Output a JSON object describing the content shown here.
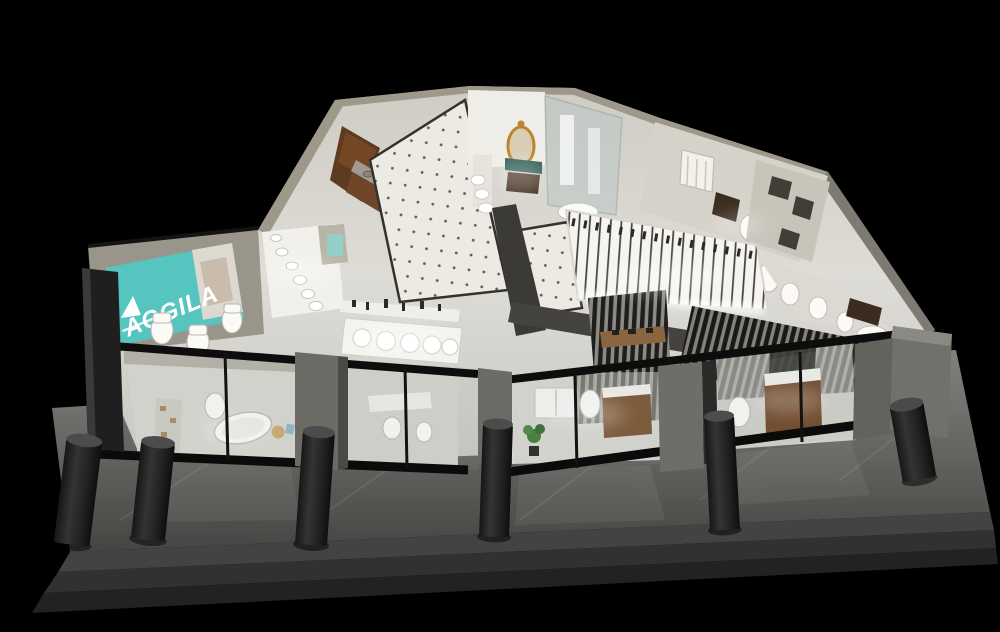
{
  "scene": {
    "description": "Aerial 3D render of a bathroom-fixtures showroom at night on black background",
    "brand_sign": {
      "text": "AGGILA",
      "bg_color": "#57c5bf",
      "text_color": "#ffffff"
    },
    "palette": {
      "background": "#000000",
      "showroom_floor": "#d7d5cf",
      "dotted_tile": "#eceae3",
      "beige_wall": "#9a958a",
      "wood_cabinet": "#6e4526",
      "walkway": "#6e6e6a",
      "steps": "#3a3a3a",
      "bollard": "#242424",
      "pilaster": "#6b6a64",
      "glass_frame": "#0d0d0d",
      "slat_dark": "#1e1e1c",
      "gold_mirror": "#b9862f",
      "plant_green": "#3f7a36",
      "teal_sign": "#57c5bf"
    },
    "counts": {
      "bollards": 6,
      "steps": 3,
      "storefront_piers": 5
    },
    "areas": [
      "brand-lightbox-sign",
      "wall-hung-sink-display",
      "wooden-vanity-gallery",
      "dotted-tile-gallery",
      "countertop-sink-tables",
      "luxury-vanity-room",
      "glass-shower-room",
      "shower-fixture-wall",
      "slatted-partitions",
      "toilet-displays",
      "bathtub-display-room",
      "vanity-display-room",
      "storefront-glazing",
      "entrance-walkway"
    ]
  }
}
